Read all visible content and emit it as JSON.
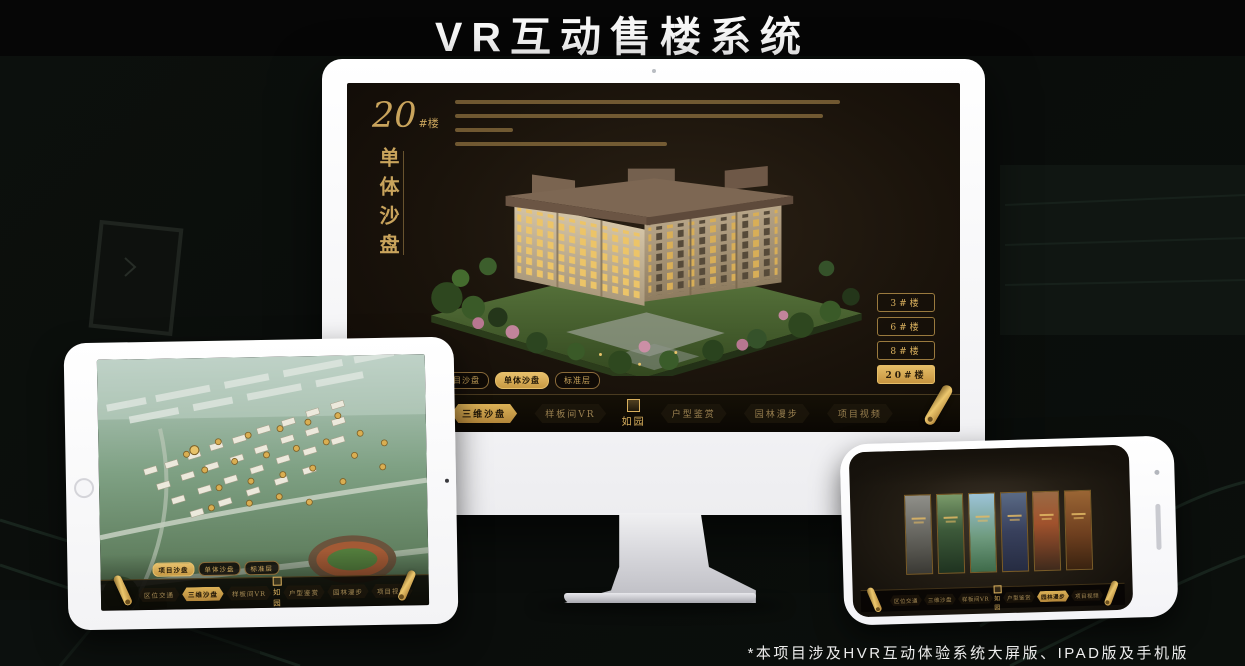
{
  "page": {
    "title": "VR互动售楼系统",
    "footnote": "*本项目涉及HVR互动体验系统大屏版、IPAD版及手机版"
  },
  "brand": {
    "logo": "如园"
  },
  "nav": {
    "items": [
      "区位交通",
      "三维沙盘",
      "样板间VR",
      "户型鉴赏",
      "园林漫步",
      "项目视频"
    ]
  },
  "tabs": [
    "项目沙盘",
    "单体沙盘",
    "标准层"
  ],
  "monitor": {
    "building_no": "20",
    "building_suffix": "#楼",
    "vertical_label": "单体沙盘",
    "floor_buttons": [
      "3#楼",
      "6#楼",
      "8#楼",
      "20#楼"
    ],
    "active_floor": "20#楼",
    "active_tab": "单体沙盘",
    "active_nav": "三维沙盘"
  },
  "ipad": {
    "active_tab": "项目沙盘",
    "active_nav": "三维沙盘"
  },
  "phone": {
    "active_nav": "园林漫步"
  },
  "icons": {
    "scroll_handle": "rolled-scroll",
    "brand_seal": "seal-stamp",
    "camera": "camera-dot",
    "home_button": "home-circle"
  },
  "colors": {
    "gold": "#c9a45c",
    "gold_bright": "#e2b964",
    "screen_bg": "#1a130b",
    "nav_bg": "#0b0804"
  }
}
